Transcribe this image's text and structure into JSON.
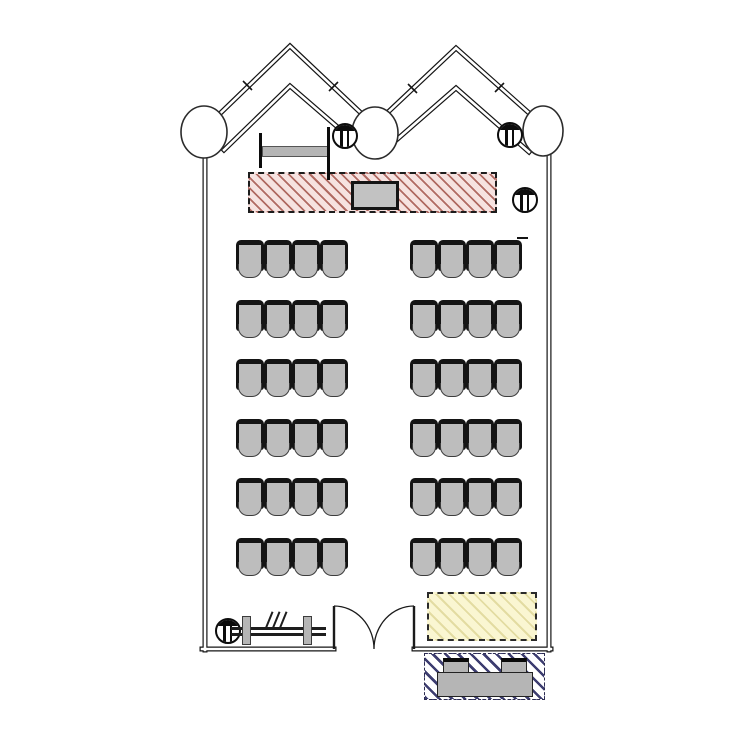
{
  "plan": {
    "type": "architectural-floor-plan",
    "room": "lecture-hall",
    "colors": {
      "wall": "#141414",
      "chair_fill": "#bdbdbd",
      "chair_outline": "#141414",
      "stage_bg": "#f6e2e0",
      "stage_hatch": "#b06a62",
      "lectern_fill": "#c2c2c2",
      "carpet_bg": "#faf6d2",
      "carpet_hatch": "#e3dca2",
      "tech_hatch": "#3d3d70",
      "desk_fill": "#b5b5b5",
      "furniture_gray": "#b5b5b5"
    },
    "seating": {
      "rows": 6,
      "blocks_per_row": 2,
      "seats_per_block": 4,
      "total_seats": 48
    },
    "features": {
      "columns_round": 3,
      "columns_striped": 4,
      "door": "double-swing",
      "stage": "hatched-platform-with-lectern",
      "carpet_zone": "dashed-hatched-rectangle",
      "tech_area": "external-hatched-zone-with-console",
      "coat_rack": 1,
      "wall_table": 1,
      "roof_wall": "sawtooth-double-peak"
    }
  }
}
